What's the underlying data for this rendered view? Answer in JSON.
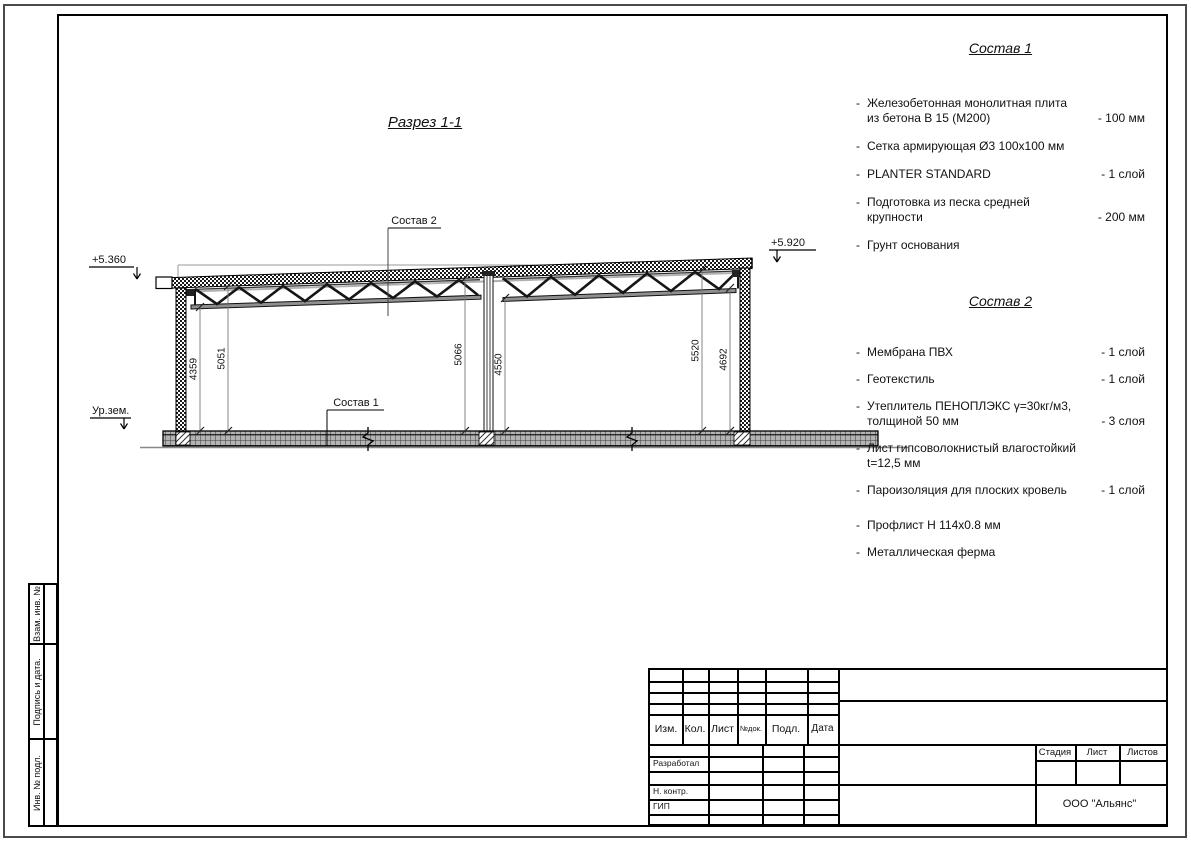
{
  "ui": {
    "dash": "-"
  },
  "drawing": {
    "title": "Разрез 1-1",
    "elevation_left": "+5.360",
    "elevation_right": "+5.920",
    "ground_label": "Ур.зем.",
    "callout_roof": "Состав 2",
    "callout_floor": "Состав 1",
    "dimensions": [
      "4359",
      "5051",
      "5066",
      "4550",
      "5520",
      "4692"
    ]
  },
  "spec1": {
    "title": "Состав 1",
    "items": [
      {
        "text": "Железобетонная  монолитная плита\nиз бетона В 15 (М200)",
        "value": "- 100 мм"
      },
      {
        "text": "Сетка армирующая Ø3 100х100 мм",
        "value": ""
      },
      {
        "text": "PLANTER STANDARD",
        "value": "- 1  слой"
      },
      {
        "text": "Подготовка из песка средней\nкрупности",
        "value": "- 200 мм"
      },
      {
        "text": "Грунт основания",
        "value": ""
      }
    ]
  },
  "spec2": {
    "title": "Состав 2",
    "items": [
      {
        "text": "Мембрана ПВХ",
        "value": "- 1 слой"
      },
      {
        "text": "Геотекстиль",
        "value": "- 1 слой"
      },
      {
        "text": "Утеплитель ПЕНОПЛЭКС γ=30кг/м3,\nтолщиной 50 мм",
        "value": "- 3 слоя"
      },
      {
        "text": "Лист гипсоволокнистый влагостойкий\nt=12,5 мм",
        "value": ""
      },
      {
        "text": "Пароизоляция для плоских кровель",
        "value": "- 1 слой"
      },
      {
        "text": "Профлист Н 114х0.8 мм",
        "value": ""
      },
      {
        "text": "Металлическая ферма",
        "value": ""
      }
    ]
  },
  "titleblock": {
    "cols": [
      "Изм.",
      "Кол.",
      "Лист",
      "№док.",
      "Подл.",
      "Дата"
    ],
    "roles": [
      "Разработал",
      "Н. контр.",
      "ГИП"
    ],
    "stage": [
      "Стадия",
      "Лист",
      "Листов"
    ],
    "company": "ООО \"Альянс\""
  },
  "side_stamp": {
    "cells": [
      "Взам. инв. №",
      "Подпись  и  дата.",
      "Инв. № подл."
    ]
  }
}
